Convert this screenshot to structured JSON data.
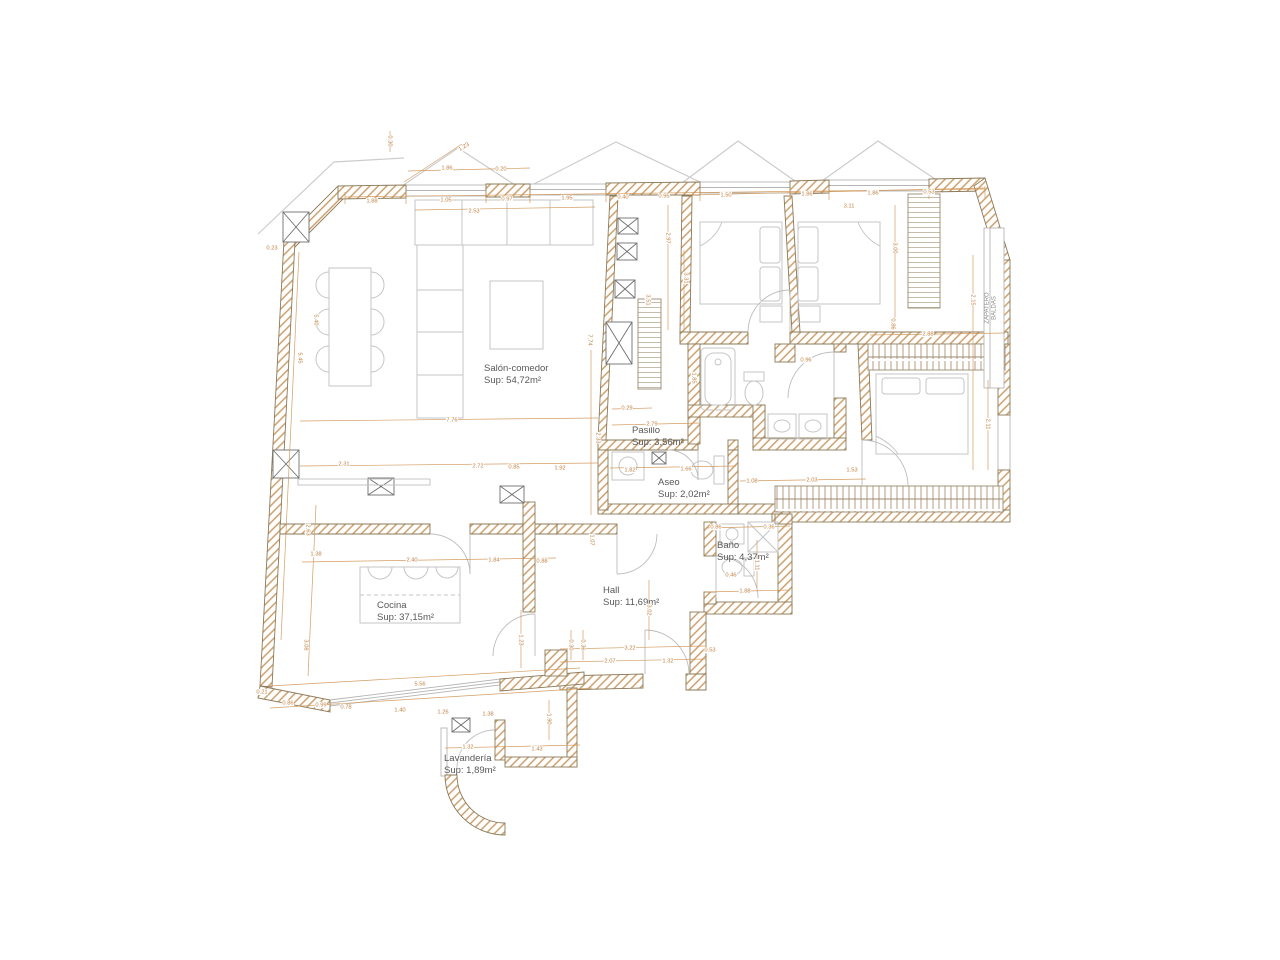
{
  "meta": {
    "drawing_type": "apartment floor plan",
    "language": "es"
  },
  "colors": {
    "background": "#ffffff",
    "wall_hatch": "#c99a62",
    "wall_outline": "#8c7a58",
    "dimension_accent": "#c08040",
    "furniture_line": "#c6c6c6",
    "label_text": "#585858"
  },
  "rooms": [
    {
      "id": "salon",
      "name": "Salón-comedor",
      "area": "Sup: 54,72m²",
      "x": 484,
      "y": 363
    },
    {
      "id": "pasillo",
      "name": "Pasillo",
      "area": "Sup: 3,56m²",
      "x": 632,
      "y": 425
    },
    {
      "id": "aseo",
      "name": "Aseo",
      "area": "Sup: 2,02m²",
      "x": 658,
      "y": 477
    },
    {
      "id": "bano",
      "name": "Baño",
      "area": "Sup: 4,37m²",
      "x": 717,
      "y": 540
    },
    {
      "id": "hall",
      "name": "Hall",
      "area": "Sup: 11,69m²",
      "x": 603,
      "y": 585
    },
    {
      "id": "cocina",
      "name": "Cocina",
      "area": "Sup: 37,15m²",
      "x": 377,
      "y": 600
    },
    {
      "id": "lavanderia",
      "name": "Lavandería",
      "area": "Sup: 1,89m²",
      "x": 444,
      "y": 753
    }
  ],
  "annotations": [
    {
      "id": "zapatero",
      "lines": [
        "ZAPATERO",
        "BALDAS"
      ],
      "x": 991,
      "y": 308,
      "r": -90
    }
  ],
  "dimensions": [
    {
      "v": "0.30",
      "x": 390,
      "y": 141,
      "r": 90
    },
    {
      "v": "1.23",
      "x": 464,
      "y": 147,
      "r": -33
    },
    {
      "v": "1.86",
      "x": 447,
      "y": 168
    },
    {
      "v": "0.20",
      "x": 501,
      "y": 169
    },
    {
      "v": "1.88",
      "x": 372,
      "y": 201
    },
    {
      "v": "1.05",
      "x": 446,
      "y": 200
    },
    {
      "v": "0.97",
      "x": 507,
      "y": 199
    },
    {
      "v": "1.95",
      "x": 567,
      "y": 198
    },
    {
      "v": "0.40",
      "x": 623,
      "y": 197
    },
    {
      "v": "0.95",
      "x": 664,
      "y": 196
    },
    {
      "v": "1.50",
      "x": 726,
      "y": 195
    },
    {
      "v": "1.86",
      "x": 807,
      "y": 194
    },
    {
      "v": "1.86",
      "x": 873,
      "y": 193
    },
    {
      "v": "0.53",
      "x": 929,
      "y": 192
    },
    {
      "v": "2.53",
      "x": 474,
      "y": 211
    },
    {
      "v": "3.11",
      "x": 849,
      "y": 206
    },
    {
      "v": "0.23",
      "x": 272,
      "y": 248
    },
    {
      "v": "5.45",
      "x": 300,
      "y": 358,
      "r": 90
    },
    {
      "v": "5.40",
      "x": 316,
      "y": 320,
      "r": 90
    },
    {
      "v": "2.63",
      "x": 308,
      "y": 530,
      "r": 90
    },
    {
      "v": "3.08",
      "x": 306,
      "y": 645,
      "r": 90
    },
    {
      "v": "0.21",
      "x": 262,
      "y": 692
    },
    {
      "v": "7.76",
      "x": 452,
      "y": 420
    },
    {
      "v": "2.33",
      "x": 598,
      "y": 438,
      "r": 90
    },
    {
      "v": "2.31",
      "x": 344,
      "y": 464
    },
    {
      "v": "2.72",
      "x": 478,
      "y": 466
    },
    {
      "v": "0.85",
      "x": 514,
      "y": 467
    },
    {
      "v": "1.92",
      "x": 560,
      "y": 468
    },
    {
      "v": "7.74",
      "x": 590,
      "y": 340,
      "r": 90
    },
    {
      "v": "2.97",
      "x": 668,
      "y": 238,
      "r": 90
    },
    {
      "v": "3.51",
      "x": 648,
      "y": 300,
      "r": 90
    },
    {
      "v": "0.29",
      "x": 627,
      "y": 408
    },
    {
      "v": "2.79",
      "x": 652,
      "y": 424
    },
    {
      "v": "1.82",
      "x": 630,
      "y": 470
    },
    {
      "v": "1.66",
      "x": 686,
      "y": 469
    },
    {
      "v": "1.53",
      "x": 852,
      "y": 470
    },
    {
      "v": "1.08",
      "x": 752,
      "y": 481
    },
    {
      "v": "2.03",
      "x": 812,
      "y": 480
    },
    {
      "v": "3.31",
      "x": 686,
      "y": 278,
      "r": 90
    },
    {
      "v": "3.00",
      "x": 895,
      "y": 248,
      "r": 90
    },
    {
      "v": "0.86",
      "x": 893,
      "y": 324,
      "r": 90
    },
    {
      "v": "2.88",
      "x": 928,
      "y": 334
    },
    {
      "v": "2.15",
      "x": 973,
      "y": 300,
      "r": 90
    },
    {
      "v": "2.11",
      "x": 988,
      "y": 424,
      "r": 90
    },
    {
      "v": "1.85",
      "x": 694,
      "y": 378,
      "r": 90
    },
    {
      "v": "0.96",
      "x": 806,
      "y": 360
    },
    {
      "v": "1.38",
      "x": 316,
      "y": 554
    },
    {
      "v": "2.40",
      "x": 412,
      "y": 560
    },
    {
      "v": "1.84",
      "x": 494,
      "y": 560
    },
    {
      "v": "0.88",
      "x": 542,
      "y": 561
    },
    {
      "v": "1.23",
      "x": 521,
      "y": 640,
      "r": 90
    },
    {
      "v": "5.56",
      "x": 420,
      "y": 684
    },
    {
      "v": "0.86",
      "x": 288,
      "y": 703
    },
    {
      "v": "0.99",
      "x": 321,
      "y": 705
    },
    {
      "v": "0.78",
      "x": 346,
      "y": 707
    },
    {
      "v": "1.40",
      "x": 400,
      "y": 710
    },
    {
      "v": "1.26",
      "x": 443,
      "y": 712
    },
    {
      "v": "1.38",
      "x": 488,
      "y": 714
    },
    {
      "v": "1.07",
      "x": 592,
      "y": 540,
      "r": 90
    },
    {
      "v": "3.22",
      "x": 630,
      "y": 648
    },
    {
      "v": "2.07",
      "x": 610,
      "y": 661
    },
    {
      "v": "1.32",
      "x": 668,
      "y": 661
    },
    {
      "v": "0.53",
      "x": 710,
      "y": 650
    },
    {
      "v": "0.30",
      "x": 571,
      "y": 645,
      "r": 90
    },
    {
      "v": "0.36",
      "x": 583,
      "y": 645,
      "r": 90
    },
    {
      "v": "3.02",
      "x": 649,
      "y": 610,
      "r": 90
    },
    {
      "v": "0.86",
      "x": 716,
      "y": 527
    },
    {
      "v": "0.36",
      "x": 769,
      "y": 527
    },
    {
      "v": "1.11",
      "x": 757,
      "y": 565,
      "r": 90
    },
    {
      "v": "0.46",
      "x": 731,
      "y": 575
    },
    {
      "v": "1.88",
      "x": 745,
      "y": 591
    },
    {
      "v": "1.32",
      "x": 468,
      "y": 747
    },
    {
      "v": "1.43",
      "x": 537,
      "y": 749
    },
    {
      "v": "1.90",
      "x": 549,
      "y": 719,
      "r": 90
    }
  ]
}
